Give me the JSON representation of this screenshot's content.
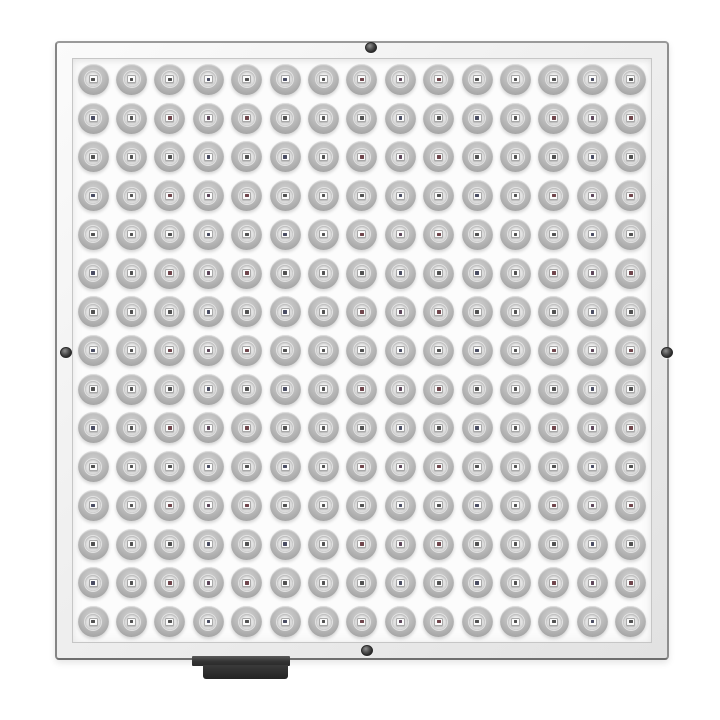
{
  "scene": {
    "type": "product photo",
    "subject": "Square LED grow light panel, front view on white background",
    "background_color": "#ffffff"
  },
  "panel": {
    "shape": "square",
    "frame": {
      "material_look": "silver aluminum",
      "bevel_color": "#ededed",
      "edge_color": "#8a8a8a",
      "inner_line_color": "#c6c6c6"
    },
    "face": {
      "color": "#fcfcfc"
    },
    "led_grid": {
      "rows": 15,
      "cols": 15,
      "total_leds": 225,
      "cup_color": "#b3b3b3",
      "cup_highlight_color": "#d2d2d2",
      "well_color": "#e6e6e6",
      "chip_color": "#fbfbfb",
      "chip_border_color": "#a8a8a8",
      "dot_colors": [
        "#515151",
        "#515151",
        "#6f454b",
        "#515151",
        "#494c62",
        "#515151",
        "#6f454b",
        "#515151",
        "#494c62",
        "#5c4559"
      ]
    },
    "screws": [
      {
        "id": "screw-top",
        "position": "top-center"
      },
      {
        "id": "screw-bottom",
        "position": "bottom-center"
      },
      {
        "id": "screw-left",
        "position": "left-middle"
      },
      {
        "id": "screw-right",
        "position": "right-middle"
      }
    ],
    "screw_color": "#2e2e2e",
    "connector": {
      "position": "bottom edge, left of center",
      "color": "#2f2f2f"
    }
  }
}
